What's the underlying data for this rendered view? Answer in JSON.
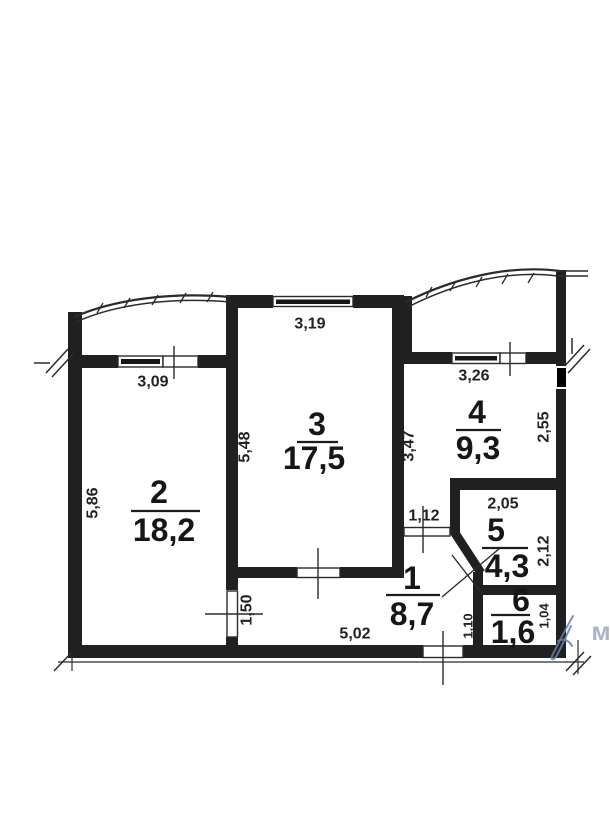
{
  "plan": {
    "title": "apartment-floor-plan",
    "rooms": [
      {
        "number": "1",
        "area": "8,7"
      },
      {
        "number": "2",
        "area": "18,2"
      },
      {
        "number": "3",
        "area": "17,5"
      },
      {
        "number": "4",
        "area": "9,3"
      },
      {
        "number": "5",
        "area": "4,3"
      },
      {
        "number": "6",
        "area": "1,6"
      }
    ],
    "dimensions": {
      "room2_width": "3,09",
      "room2_depth": "5,86",
      "room3_width": "3,19",
      "room3_depth": "5,48",
      "room4_width": "3,26",
      "room4_depth": "3,47",
      "room4_right_side": "2,55",
      "room5_width": "2,05",
      "room5_depth": "2,12",
      "room4_door_width": "1,12",
      "room2_door_width": "1,50",
      "hallway_length": "5,02",
      "room6_left_side": "1,10",
      "room6_depth": "1,04"
    },
    "watermark": "м",
    "colors": {
      "ink": "#202020",
      "signature_ink": "#6a7fa8"
    }
  }
}
